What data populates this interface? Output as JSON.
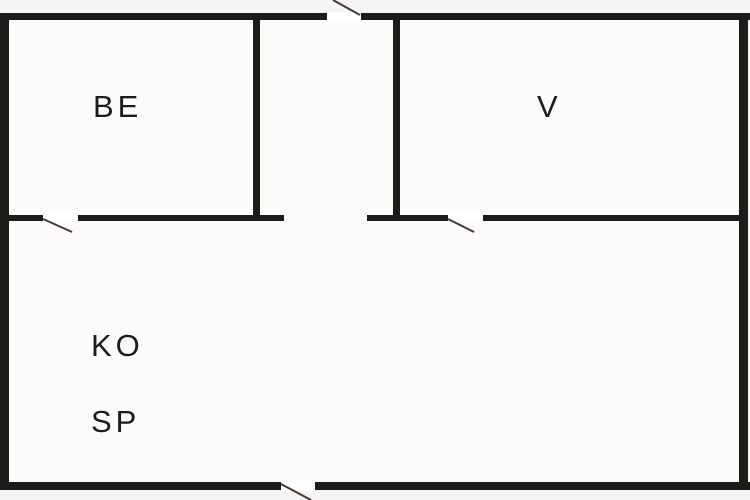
{
  "canvas": {
    "width": 750,
    "height": 500
  },
  "colors": {
    "outside_bg": "#f5f4f2",
    "interior_bg": "#fcfbf9",
    "wall": "#1e1c19",
    "door_line": "#3f3c38",
    "opening": "#ffffff",
    "text": "#1e1c19"
  },
  "typography": {
    "label_font_size": 31,
    "label_letter_spacing": 4
  },
  "floorplan": {
    "interior": {
      "x": 9,
      "y": 19,
      "w": 730,
      "h": 464
    },
    "rooms": [
      {
        "id": "be",
        "label": "BE",
        "x": 93,
        "y": 117
      },
      {
        "id": "v",
        "label": "V",
        "x": 537,
        "y": 117
      },
      {
        "id": "ko",
        "label": "KO",
        "x": 91,
        "y": 356
      },
      {
        "id": "sp",
        "label": "SP",
        "x": 91,
        "y": 432
      }
    ],
    "walls": [
      {
        "id": "top-left",
        "x": 0,
        "y": 13,
        "w": 327,
        "h": 7
      },
      {
        "id": "top-right",
        "x": 361,
        "y": 13,
        "w": 389,
        "h": 7
      },
      {
        "id": "left-outer",
        "x": 0,
        "y": 13,
        "w": 9,
        "h": 477
      },
      {
        "id": "right-outer",
        "x": 739,
        "y": 13,
        "w": 9,
        "h": 477
      },
      {
        "id": "bottom-left",
        "x": 0,
        "y": 482,
        "w": 281,
        "h": 8
      },
      {
        "id": "bottom-right",
        "x": 315,
        "y": 482,
        "w": 435,
        "h": 8
      },
      {
        "id": "be-divider",
        "x": 253,
        "y": 13,
        "w": 7,
        "h": 208
      },
      {
        "id": "v-divider",
        "x": 393,
        "y": 13,
        "w": 7,
        "h": 208
      },
      {
        "id": "mid-segment-a",
        "x": 9,
        "y": 215,
        "w": 34,
        "h": 6
      },
      {
        "id": "mid-segment-b",
        "x": 78,
        "y": 215,
        "w": 206,
        "h": 6
      },
      {
        "id": "mid-segment-c",
        "x": 367,
        "y": 215,
        "w": 81,
        "h": 6
      },
      {
        "id": "mid-segment-d",
        "x": 483,
        "y": 215,
        "w": 256,
        "h": 6
      }
    ],
    "openings": [
      {
        "id": "entry-top",
        "x": 327,
        "y": 12,
        "w": 34,
        "h": 9
      },
      {
        "id": "be-doorway",
        "x": 43,
        "y": 213,
        "w": 35,
        "h": 8
      },
      {
        "id": "v-doorway",
        "x": 448,
        "y": 213,
        "w": 35,
        "h": 8
      },
      {
        "id": "exit-bottom",
        "x": 281,
        "y": 481,
        "w": 34,
        "h": 10
      }
    ],
    "door_swings": [
      {
        "id": "entry-door",
        "x1": 333,
        "y1": 0,
        "x2": 360,
        "y2": 15
      },
      {
        "id": "be-door",
        "x1": 43,
        "y1": 219,
        "x2": 72,
        "y2": 232
      },
      {
        "id": "v-door",
        "x1": 448,
        "y1": 219,
        "x2": 474,
        "y2": 232
      },
      {
        "id": "exit-door",
        "x1": 281,
        "y1": 484,
        "x2": 311,
        "y2": 500
      }
    ]
  }
}
